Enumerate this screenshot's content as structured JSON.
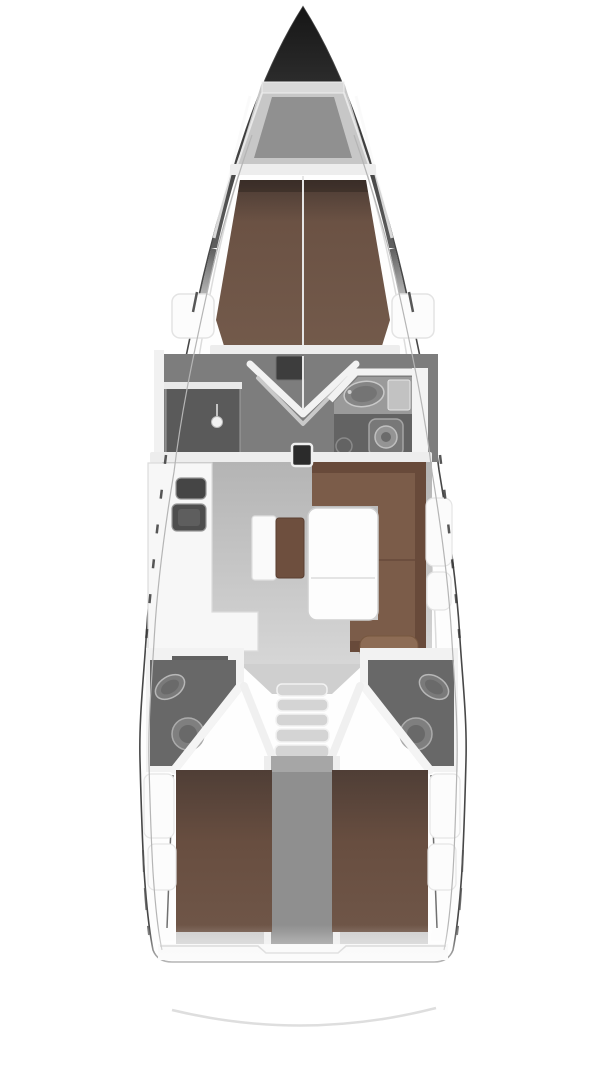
{
  "diagram": {
    "kind": "yacht-interior-floor-plan",
    "view": "overhead",
    "components": [
      "hull",
      "anchor-locker",
      "forward-v-berth",
      "wardrobe-doors",
      "shower-stall",
      "forward-head",
      "sink",
      "toilet",
      "mast-post",
      "galley",
      "galley-sinks",
      "navigation-bench",
      "salon-table",
      "l-shaped-settee",
      "companionway-steps",
      "engine-compartment",
      "aft-head-port",
      "aft-head-starboard",
      "aft-berth-port",
      "aft-berth-starboard",
      "transom"
    ]
  },
  "colors": {
    "background": "#ffffff",
    "hull_fill": "#fdfdfd",
    "hull_line": "#474747",
    "hull_inner_line": "#b5b5b5",
    "bow_dark": "#161616",
    "bow_mid": "#5f5f5f",
    "deck_grey": "#c7c7c7",
    "locker_floor": "#909090",
    "locker_bar": "#dadada",
    "bulkhead_white": "#ededed",
    "wall_white": "#f2f2f2",
    "forward_berth_dark": "#4a3a33",
    "forward_berth": "#6b5244",
    "forward_berth_light": "#735a4b",
    "dressing_floor": "#7d7d7d",
    "shower_dark": "#5a5a5a",
    "head_floor": "#636363",
    "head_counter": "#9a9a9a",
    "fixture_grey": "#858585",
    "fixture_rim": "#c9c9c9",
    "salon_floor_top": "#b4b4b4",
    "salon_floor_bottom": "#d6d6d6",
    "galley_white": "#f7f7f7",
    "sink_dark": "#4e4e4e",
    "settee_brown": "#7b5c49",
    "settee_back": "#684a3a",
    "cushion_light": "#8d6c55",
    "bench_cushion": "#6e4f3e",
    "table_white": "#fdfdfd",
    "step_grey": "#d4d4d4",
    "corridor_grey": "#8f8f8f",
    "aft_head_floor": "#686868",
    "aft_berth_dark": "#4f3e36",
    "aft_berth": "#684e40",
    "aft_berth_light": "#6f5648",
    "stern_floor": "#cdcdcd",
    "transom_arc": "#dedede",
    "mast_post": "#2b2b2b"
  }
}
